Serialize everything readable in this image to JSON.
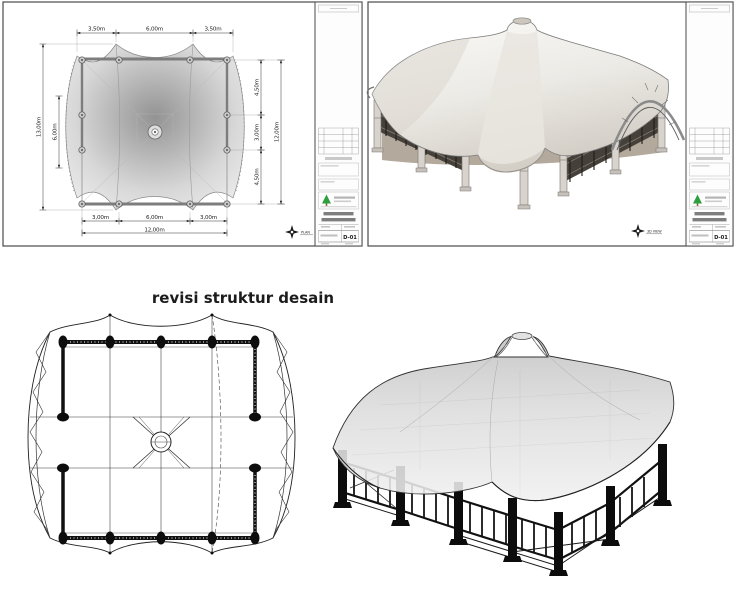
{
  "revision": {
    "title": "revisi struktur desain"
  },
  "sheet_plan": {
    "view_label": "PLAN",
    "sheet_number": "D-01",
    "dims_top": [
      "3,50m",
      "6,00m",
      "3,50m"
    ],
    "dims_bottom": [
      "3,00m",
      "6,00m",
      "3,00m"
    ],
    "dim_bottom_total": "12,00m",
    "dim_left_outer": "13,00m",
    "dim_left_inner": "6,00m",
    "dims_right": [
      "4,50m",
      "3,00m",
      "4,50m"
    ],
    "dim_right_total": "12,00m"
  },
  "sheet_3d": {
    "view_label": "3D VIEW",
    "sheet_number": "D-01"
  },
  "colors": {
    "logo_green": "#2f9e3f",
    "sheet_border": "#4a4a4a",
    "membrane_gray": "#d9d9d9",
    "structure_black": "#111111",
    "fence_brown": "#46403a"
  }
}
